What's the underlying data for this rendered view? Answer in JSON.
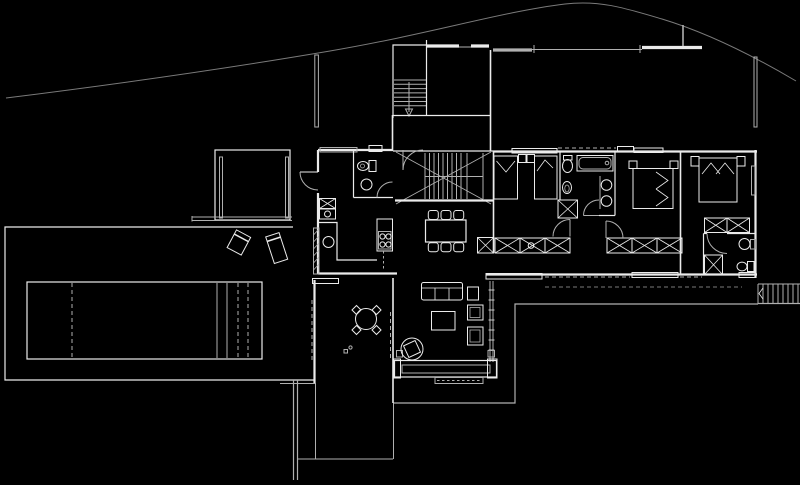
{
  "labels": {
    "drawing": "house floor plan with pool, CAD line drawing"
  },
  "canvas": {
    "viewbox": "0 0 800 485",
    "width": 800,
    "height": 485
  },
  "colors": {
    "background": "#000000",
    "line_bright": "#ebebeb",
    "line_mid": "#b0b0b0",
    "line_dim": "#7a7a7a"
  }
}
